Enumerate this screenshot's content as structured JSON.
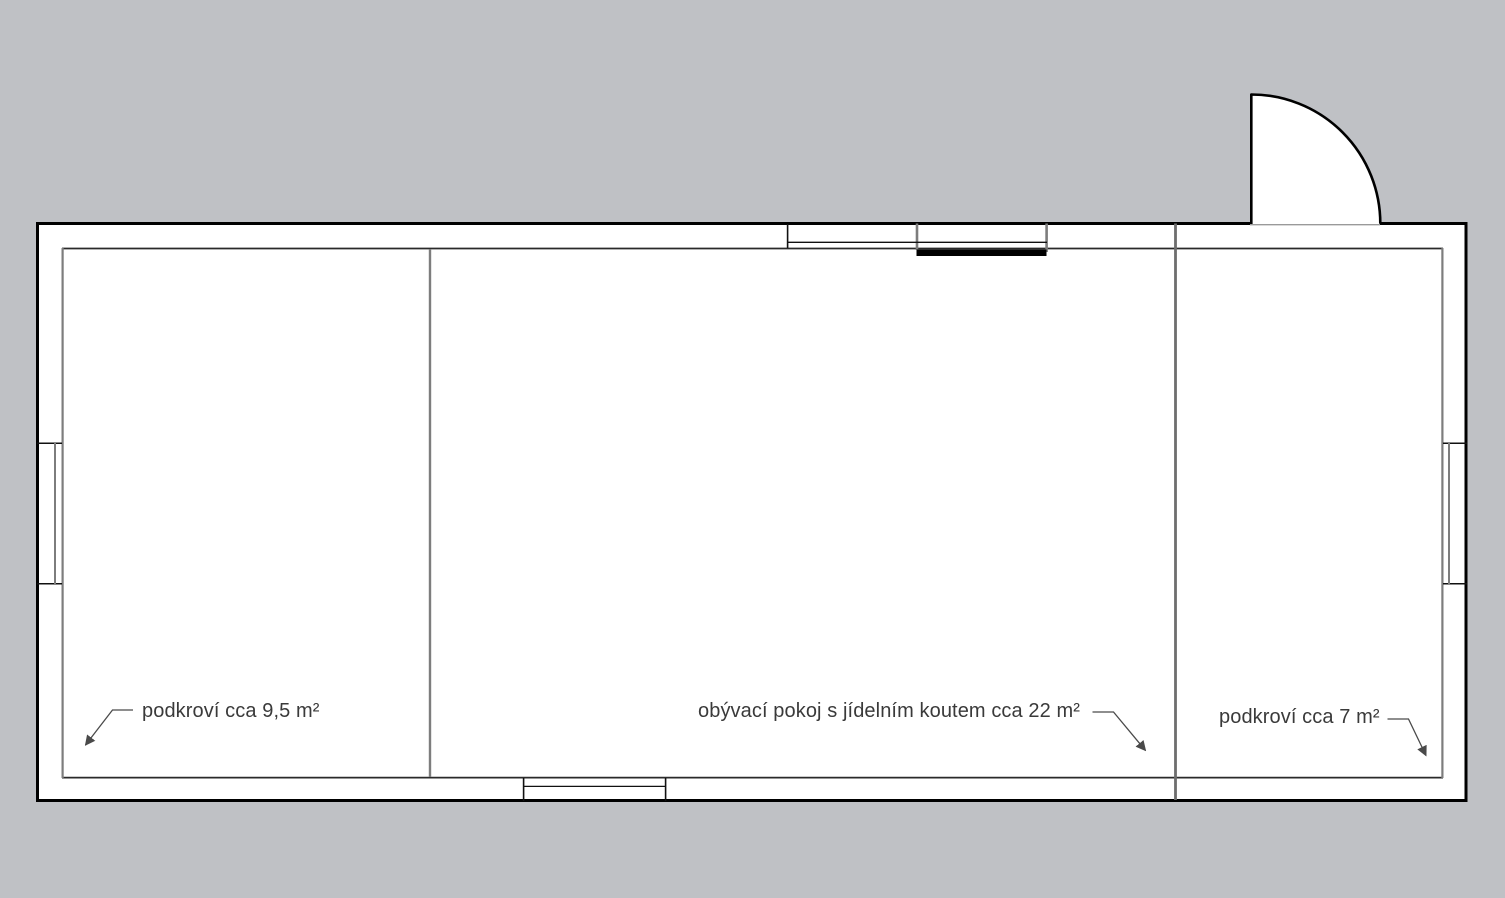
{
  "plan": {
    "type": "floor-plan",
    "rooms": [
      {
        "name": "left-attic",
        "label": "podkroví cca 9,5 m²"
      },
      {
        "name": "living-room",
        "label": "obývací pokoj s jídelním koutem cca 22 m²"
      },
      {
        "name": "right-attic",
        "label": "podkroví cca 7 m²"
      }
    ],
    "colors": {
      "background": "#bfc1c5",
      "wall_fill": "#ffffff",
      "wall_outline": "#000000",
      "interior_line": "#2a2a2a",
      "partition": "#7d7d7d",
      "door_threshold": "#9a9a9a",
      "label_text": "#3a3a3a",
      "leader_line": "#4a4a4a",
      "sill_bar": "#000000"
    }
  }
}
